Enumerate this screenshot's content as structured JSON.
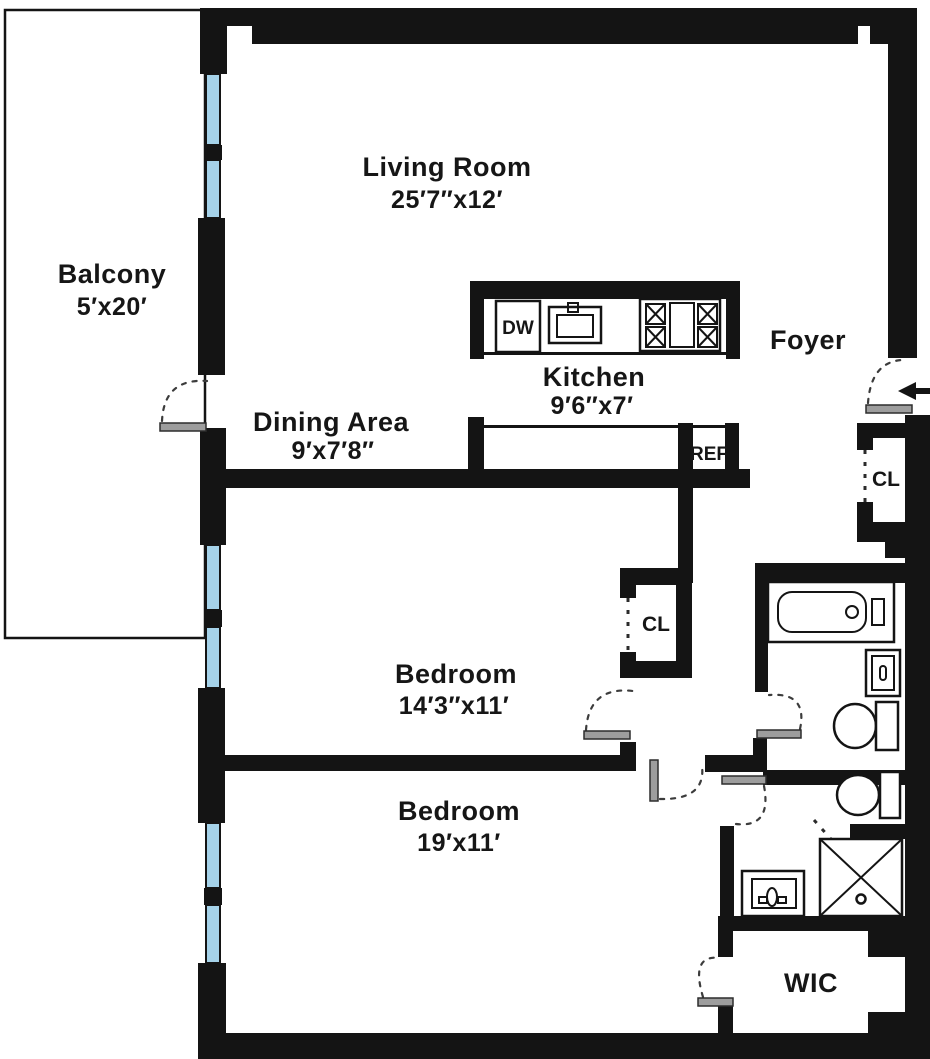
{
  "colors": {
    "wall": "#141414",
    "window": "#a5d2e9",
    "doorleaf": "#9d9d9d",
    "background": "#ffffff"
  },
  "rooms": {
    "living": {
      "name": "Living Room",
      "dims": "25′7″x12′"
    },
    "balcony": {
      "name": "Balcony",
      "dims": "5′x20′"
    },
    "dining": {
      "name": "Dining Area",
      "dims": "9′x7′8″"
    },
    "kitchen": {
      "name": "Kitchen",
      "dims": "9′6″x7′"
    },
    "foyer": {
      "name": "Foyer"
    },
    "bedroom1": {
      "name": "Bedroom",
      "dims": "14′3″x11′"
    },
    "bedroom2": {
      "name": "Bedroom",
      "dims": "19′x11′"
    },
    "wic": {
      "name": "WIC"
    },
    "closet_foyer": {
      "name": "CL"
    },
    "closet_bedroom": {
      "name": "CL"
    }
  },
  "appliances": {
    "dishwasher": "DW",
    "refrigerator": "REF"
  }
}
